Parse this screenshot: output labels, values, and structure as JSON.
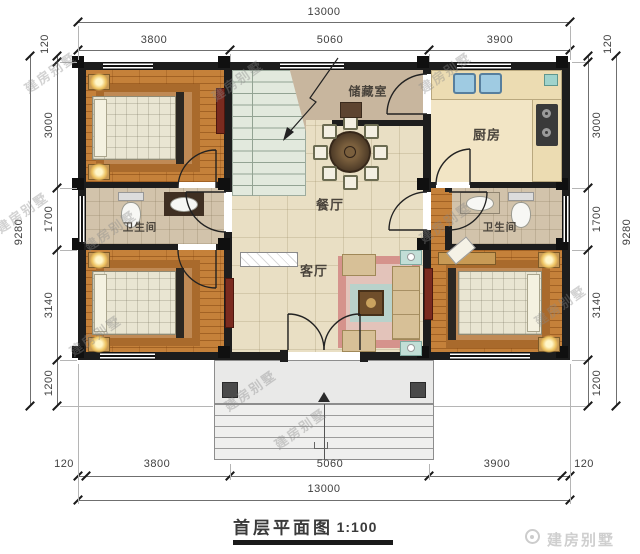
{
  "branding": {
    "watermark": "建房别墅",
    "logo_text": "建房别墅"
  },
  "title_block": {
    "title": "首层平面图",
    "scale": "1:100"
  },
  "rooms": {
    "storage": "储藏室",
    "kitchen": "厨房",
    "dining": "餐厅",
    "living": "客厅",
    "bathroom_left": "卫生间",
    "bathroom_right": "卫生间"
  },
  "dimensions": {
    "top": {
      "total": "13000",
      "segments": [
        "3800",
        "5060",
        "3900"
      ],
      "side_left": "120",
      "side_right": "120"
    },
    "bottom": {
      "total": "13000",
      "segments": [
        "3800",
        "5060",
        "3900"
      ],
      "side_left": "120",
      "side_right": "120"
    },
    "left": {
      "total": "9280",
      "segments": [
        "3000",
        "1700",
        "3140",
        "1200"
      ]
    },
    "right": {
      "total": "9280",
      "segments": [
        "3000",
        "1700",
        "3140",
        "1200"
      ]
    }
  },
  "colors": {
    "wall": "#1d1d1d",
    "wood_floor": "#c5813a",
    "tile_floor": "#e9dfc4",
    "storage_floor": "#c8b69e",
    "bath_floor": "#d2c3ab",
    "kitchen_floor": "#f2e5c5",
    "stairs": "#e2e9dd",
    "porch": "#e9e9e8",
    "dimension_text": "#3f3f3f",
    "watermark": "#8a8a8a"
  }
}
